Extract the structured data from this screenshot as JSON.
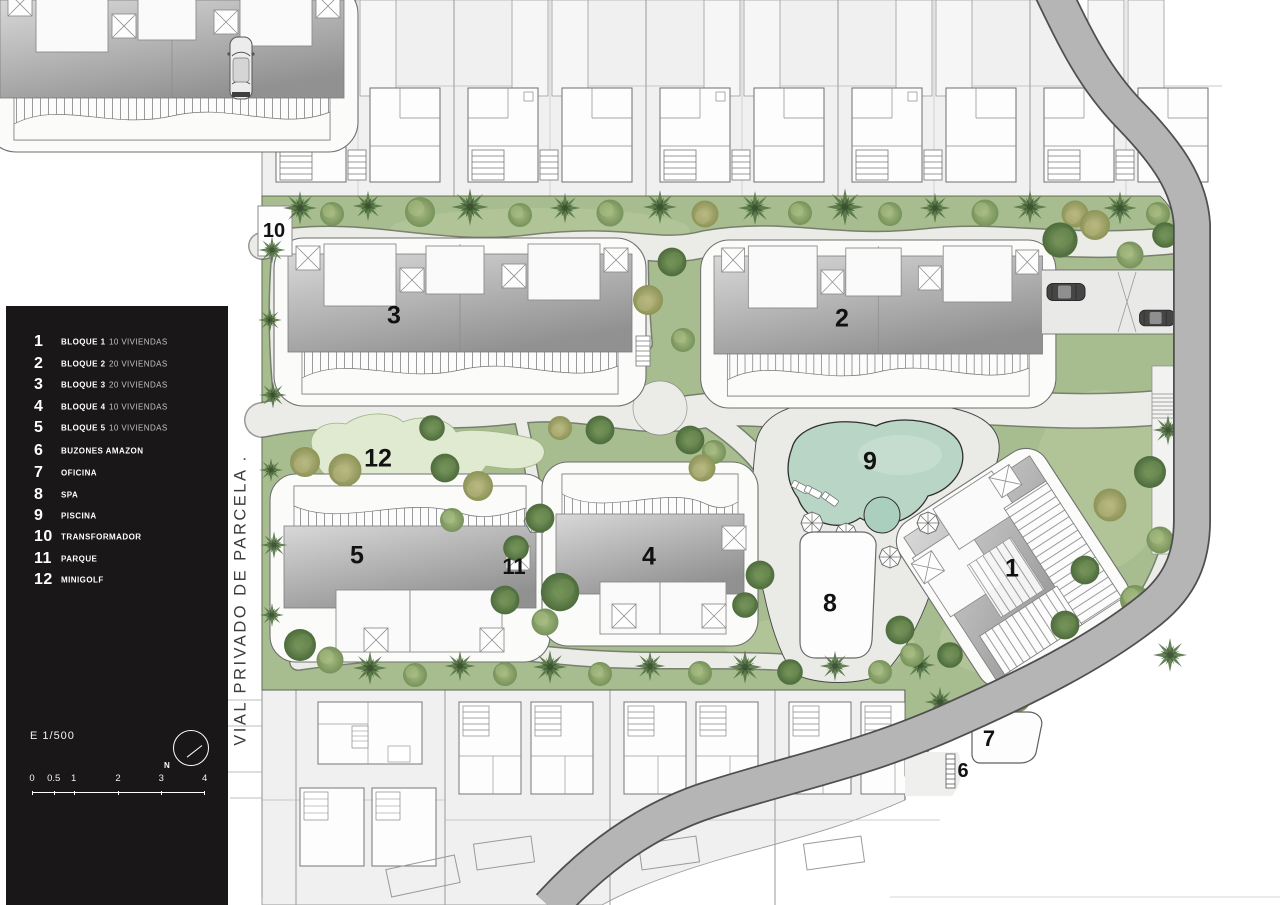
{
  "legend": {
    "items": [
      {
        "num": "1",
        "label": "BLOQUE 1",
        "detail": "10 VIVIENDAS"
      },
      {
        "num": "2",
        "label": "BLOQUE 2",
        "detail": "20 VIVIENDAS"
      },
      {
        "num": "3",
        "label": "BLOQUE 3",
        "detail": "20 VIVIENDAS"
      },
      {
        "num": "4",
        "label": "BLOQUE 4",
        "detail": "10 VIVIENDAS"
      },
      {
        "num": "5",
        "label": "BLOQUE 5",
        "detail": "10 VIVIENDAS"
      },
      {
        "num": "6",
        "label": "BUZONES AMAZON",
        "detail": ""
      },
      {
        "num": "7",
        "label": "OFICINA",
        "detail": ""
      },
      {
        "num": "8",
        "label": "SPA",
        "detail": ""
      },
      {
        "num": "9",
        "label": "PISCINA",
        "detail": ""
      },
      {
        "num": "10",
        "label": "TRANSFORMADOR",
        "detail": ""
      },
      {
        "num": "11",
        "label": "PARQUE",
        "detail": ""
      },
      {
        "num": "12",
        "label": "MINIGOLF",
        "detail": ""
      }
    ],
    "scale_label": "E 1/500",
    "scale_ticks": [
      "0",
      "0.5",
      "1",
      "2",
      "3",
      "4"
    ],
    "north_label": "N"
  },
  "road": {
    "label": "VIAL PRIVADO DE PARCELA ."
  },
  "plan": {
    "markers": [
      {
        "id": "bloque-1",
        "label": "1"
      },
      {
        "id": "bloque-2",
        "label": "2"
      },
      {
        "id": "bloque-3",
        "label": "3"
      },
      {
        "id": "bloque-4",
        "label": "4"
      },
      {
        "id": "bloque-5",
        "label": "5"
      },
      {
        "id": "buzones-amazon",
        "label": "6"
      },
      {
        "id": "oficina",
        "label": "7"
      },
      {
        "id": "spa",
        "label": "8"
      },
      {
        "id": "piscina",
        "label": "9"
      },
      {
        "id": "transformador",
        "label": "10"
      },
      {
        "id": "parque",
        "label": "11"
      },
      {
        "id": "minigolf",
        "label": "12"
      }
    ]
  },
  "colors": {
    "panel": "#1a1718",
    "grass": "#a8bd8f",
    "path": "#ebebe8",
    "road_band": "#b5b5b5",
    "pool_water": "#b9d5c6",
    "minigolf_green": "#e0ead0"
  }
}
